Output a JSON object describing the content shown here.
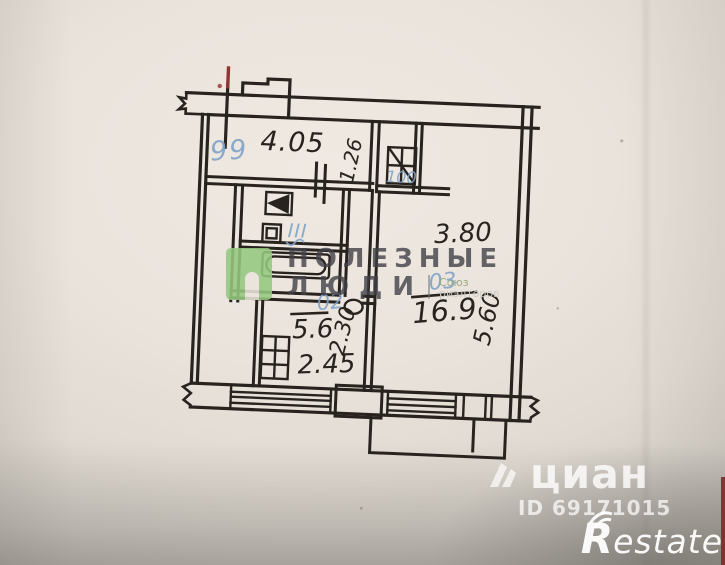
{
  "plan": {
    "dimensions": {
      "hall_width": "4.05",
      "hall_opening": "1.26",
      "living_width": "3.80",
      "living_depth": "5.60",
      "living_area": "16.9",
      "kitchen_area": "5.6",
      "kitchen_width": "2.45",
      "kitchen_depth": "2.30"
    },
    "room_numbers": {
      "hall": "99",
      "vent_shaft": "100",
      "bathroom": "III",
      "living": "03",
      "kitchen": "02"
    }
  },
  "watermarks": {
    "agency": {
      "line1": "ПОЛЕЗНЫЕ",
      "line2": "ЛЮДИ",
      "tagline_line1": "Союз",
      "tagline_line2": "риэлторов"
    },
    "cian": {
      "name": "циан",
      "listing_id": "ID 69171015"
    },
    "restate": {
      "initial": "R",
      "rest": "estate"
    }
  },
  "colors": {
    "paper": "#eae3dc",
    "ink": "#28231e",
    "pencil_blue": "#7fa3c9",
    "agency_green": "#95c97f",
    "red_mark": "#8c3732",
    "watermark_white": "#ffffff"
  }
}
